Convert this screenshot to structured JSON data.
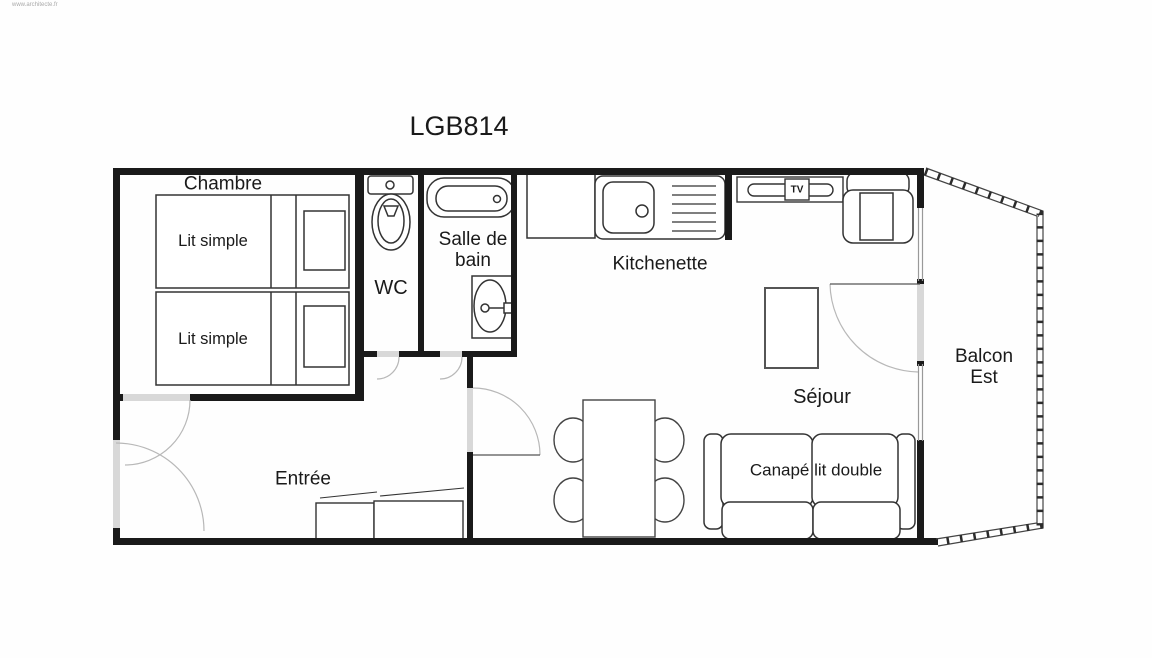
{
  "title": "LGB814",
  "watermark": "www.architecte.fr",
  "colors": {
    "wall": "#1a1a1a",
    "furniture_stroke": "#333333",
    "door_opening": "#d8d8d8",
    "door_arc": "#b8b8b8",
    "window_line": "#999999",
    "label": "#1a1a1a"
  },
  "rooms": {
    "chambre": {
      "label": "Chambre"
    },
    "wc": {
      "label": "WC"
    },
    "salle_de_bain": {
      "label": "Salle de bain",
      "line1": "Salle de",
      "line2": "bain"
    },
    "kitchenette": {
      "label": "Kitchenette"
    },
    "sejour": {
      "label": "Séjour"
    },
    "entree": {
      "label": "Entrée"
    },
    "balcon": {
      "label": "Balcon Est",
      "line1": "Balcon",
      "line2": "Est"
    }
  },
  "furniture": {
    "bed1": {
      "label": "Lit simple"
    },
    "bed2": {
      "label": "Lit simple"
    },
    "sofa": {
      "label": "Canapé lit double"
    },
    "tv": {
      "label": "TV"
    }
  }
}
